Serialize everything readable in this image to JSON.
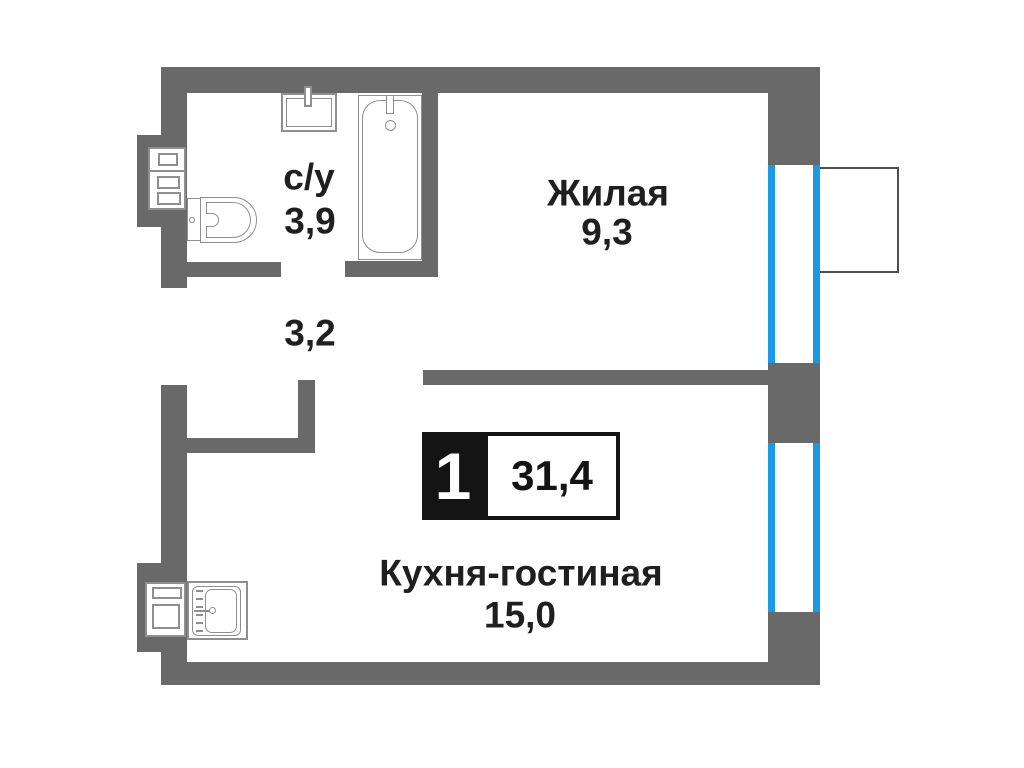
{
  "floorplan": {
    "badge": {
      "room_count": "1",
      "total_area": "31,4"
    },
    "rooms": {
      "bathroom": {
        "label": "с/у",
        "area": "3,9"
      },
      "living": {
        "label": "Жилая",
        "area": "9,3"
      },
      "hallway": {
        "area": "3,2"
      },
      "kitchen": {
        "label": "Кухня-гостиная",
        "area": "15,0"
      }
    },
    "colors": {
      "wall": "#696969",
      "window": "#1a9ae6",
      "fixture": "#8f8f8f",
      "balcony_line": "#4f4f4f",
      "text": "#1f1f1f",
      "badge": "#141414"
    }
  }
}
